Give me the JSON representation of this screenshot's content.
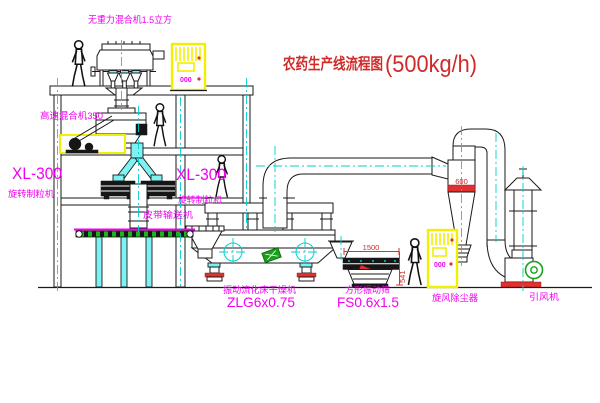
{
  "title": {
    "zh": "农药生产线流程图",
    "capacity": "(500kg/h)"
  },
  "equipment_labels": {
    "gravity_mixer": "无重力混合机1.5立方",
    "high_speed_mixer": "高速混合机350",
    "granulator_left": {
      "model": "XL-300",
      "name": "旋转制粒机"
    },
    "granulator_right": {
      "model": "XL-300",
      "name": "旋转制粒机"
    },
    "belt_conveyor": "皮带输送机",
    "fluid_bed_dryer": {
      "name": "振动流化床干燥机",
      "model": "ZLG6x0.75"
    },
    "vibrating_sieve": {
      "name": "方形振动筛",
      "model": "FS0.6x1.5"
    },
    "cyclone": "旋风除尘器",
    "induced_draft_fan": "引风机"
  },
  "dimensions": {
    "sieve_length": "1500",
    "sieve_height": "541",
    "cyclone_diameter": "600"
  },
  "control_cabinet": {
    "panel_text": "000"
  },
  "colors": {
    "label_magenta": "#f200f2",
    "title_red": "#c03030",
    "dimension_red": "#e03030",
    "centerline_cyan": "#00cfcf",
    "cabinet_yellow": "#f2ef00",
    "machine_green": "#17a317"
  }
}
